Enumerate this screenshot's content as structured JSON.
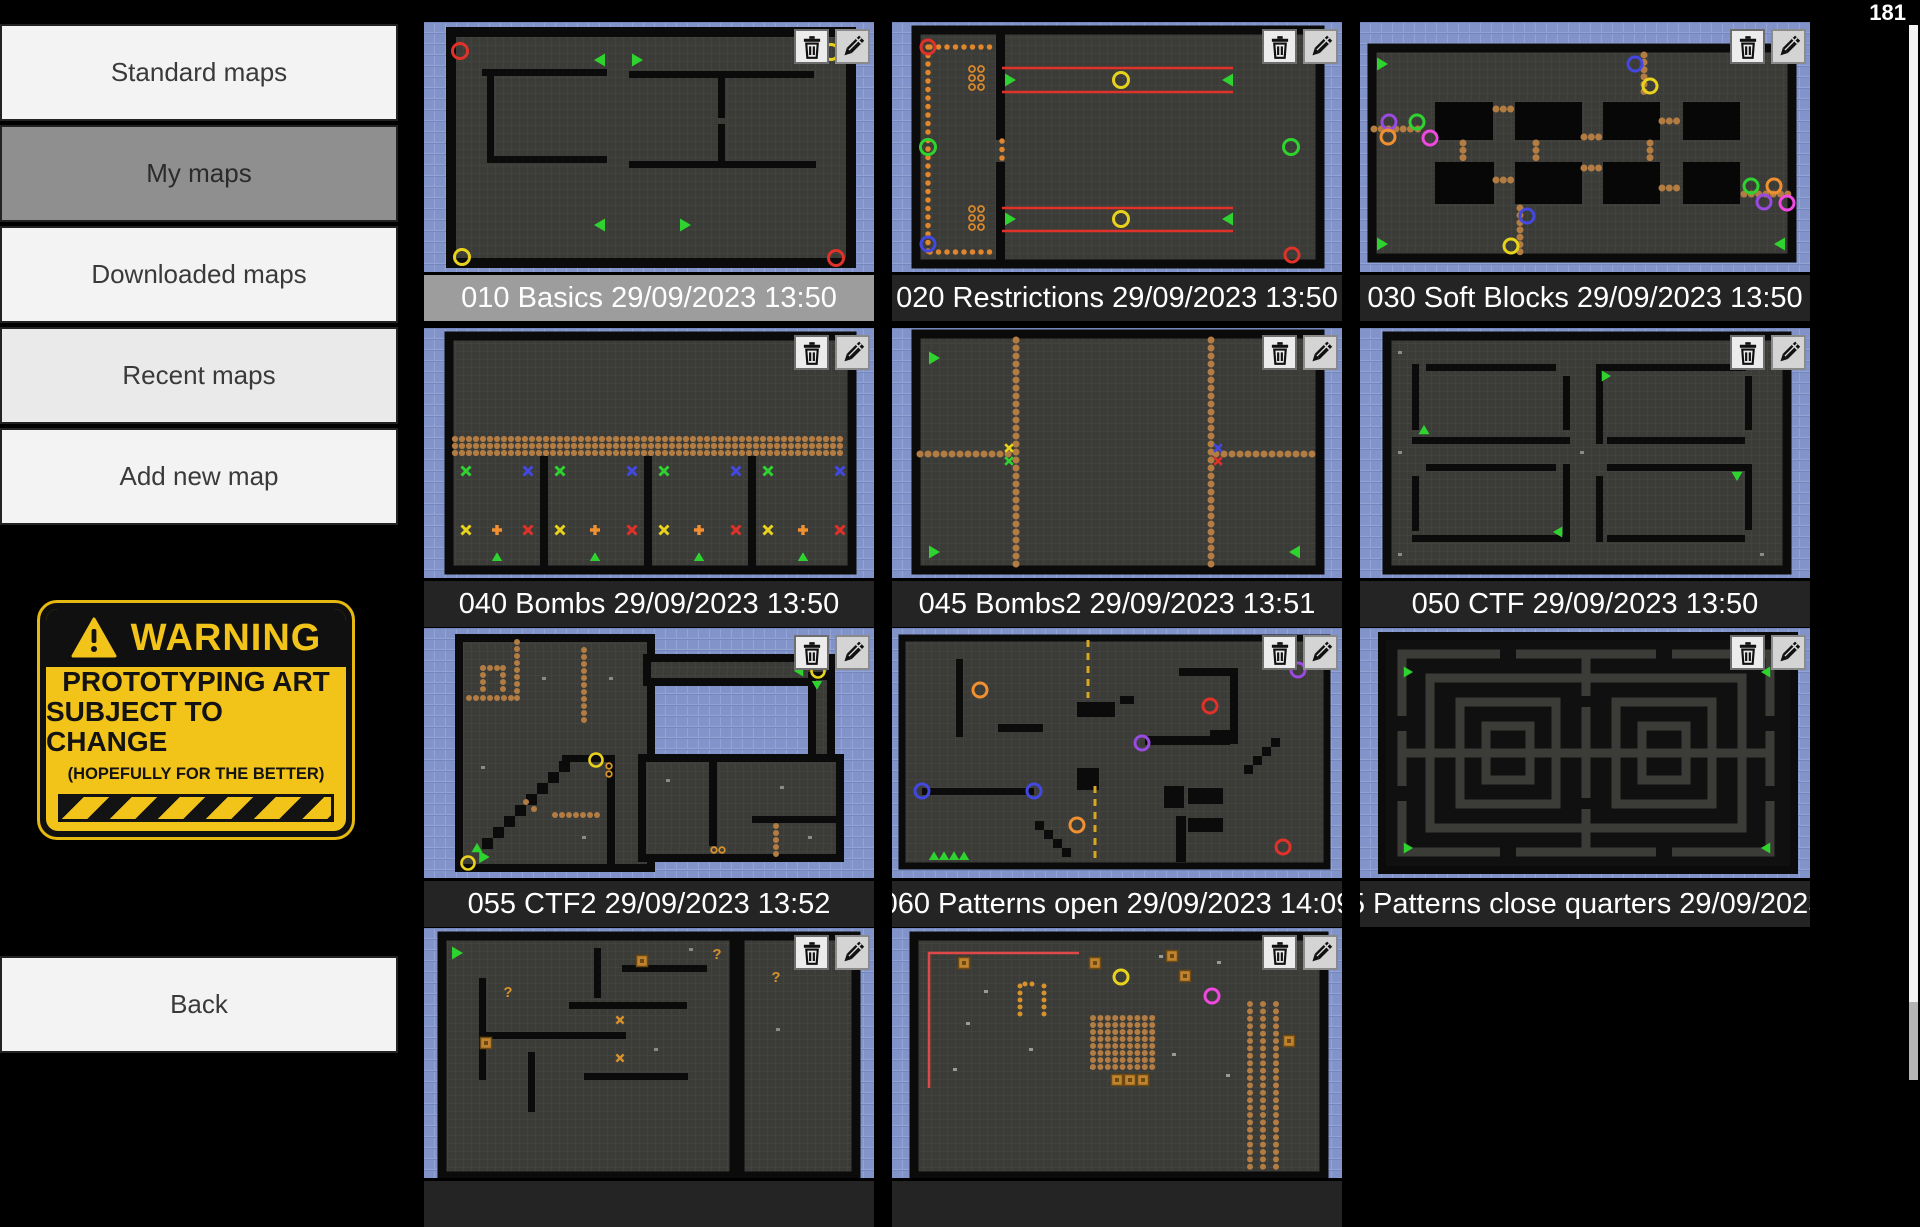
{
  "counter": "181",
  "sidebar": {
    "items": [
      {
        "label": "Standard maps",
        "selected": false
      },
      {
        "label": "My maps",
        "selected": true
      },
      {
        "label": "Downloaded maps",
        "selected": false
      },
      {
        "label": "Recent maps",
        "selected": false
      },
      {
        "label": "Add new map",
        "selected": false
      }
    ],
    "back_label": "Back"
  },
  "warning_sign": {
    "title": "WARNING",
    "line1": "PROTOTYPING ART",
    "line2": "SUBJECT TO CHANGE",
    "line3": "(HOPEFULLY FOR THE BETTER)"
  },
  "maps": [
    {
      "title": "010 Basics 29/09/2023 13:50",
      "highlighted": true
    },
    {
      "title": "020 Restrictions 29/09/2023 13:50",
      "highlighted": false
    },
    {
      "title": "030 Soft Blocks 29/09/2023 13:50",
      "highlighted": false
    },
    {
      "title": "040 Bombs 29/09/2023 13:50",
      "highlighted": false
    },
    {
      "title": "045 Bombs2 29/09/2023 13:51",
      "highlighted": false
    },
    {
      "title": "050 CTF 29/09/2023 13:50",
      "highlighted": false
    },
    {
      "title": "055 CTF2 29/09/2023 13:52",
      "highlighted": false
    },
    {
      "title": "060 Patterns open 29/09/2023 14:09",
      "highlighted": false
    },
    {
      "title": "065 Patterns close quarters 29/09/2023…",
      "highlighted": false
    },
    {
      "title": "",
      "highlighted": false
    },
    {
      "title": "",
      "highlighted": false
    }
  ],
  "glyphs": {
    "question": "?"
  },
  "colors": {
    "tile_blue": "#8193c9",
    "map_dark": "#3b3b37",
    "wall_black": "#0b0b0b",
    "dot_brown": "#b27c42",
    "marker_green": "#2fd32f",
    "sidebar_selected": "#8f8f8f",
    "title_bar": "#242424",
    "title_bar_highlighted": "#9d9d9d"
  }
}
